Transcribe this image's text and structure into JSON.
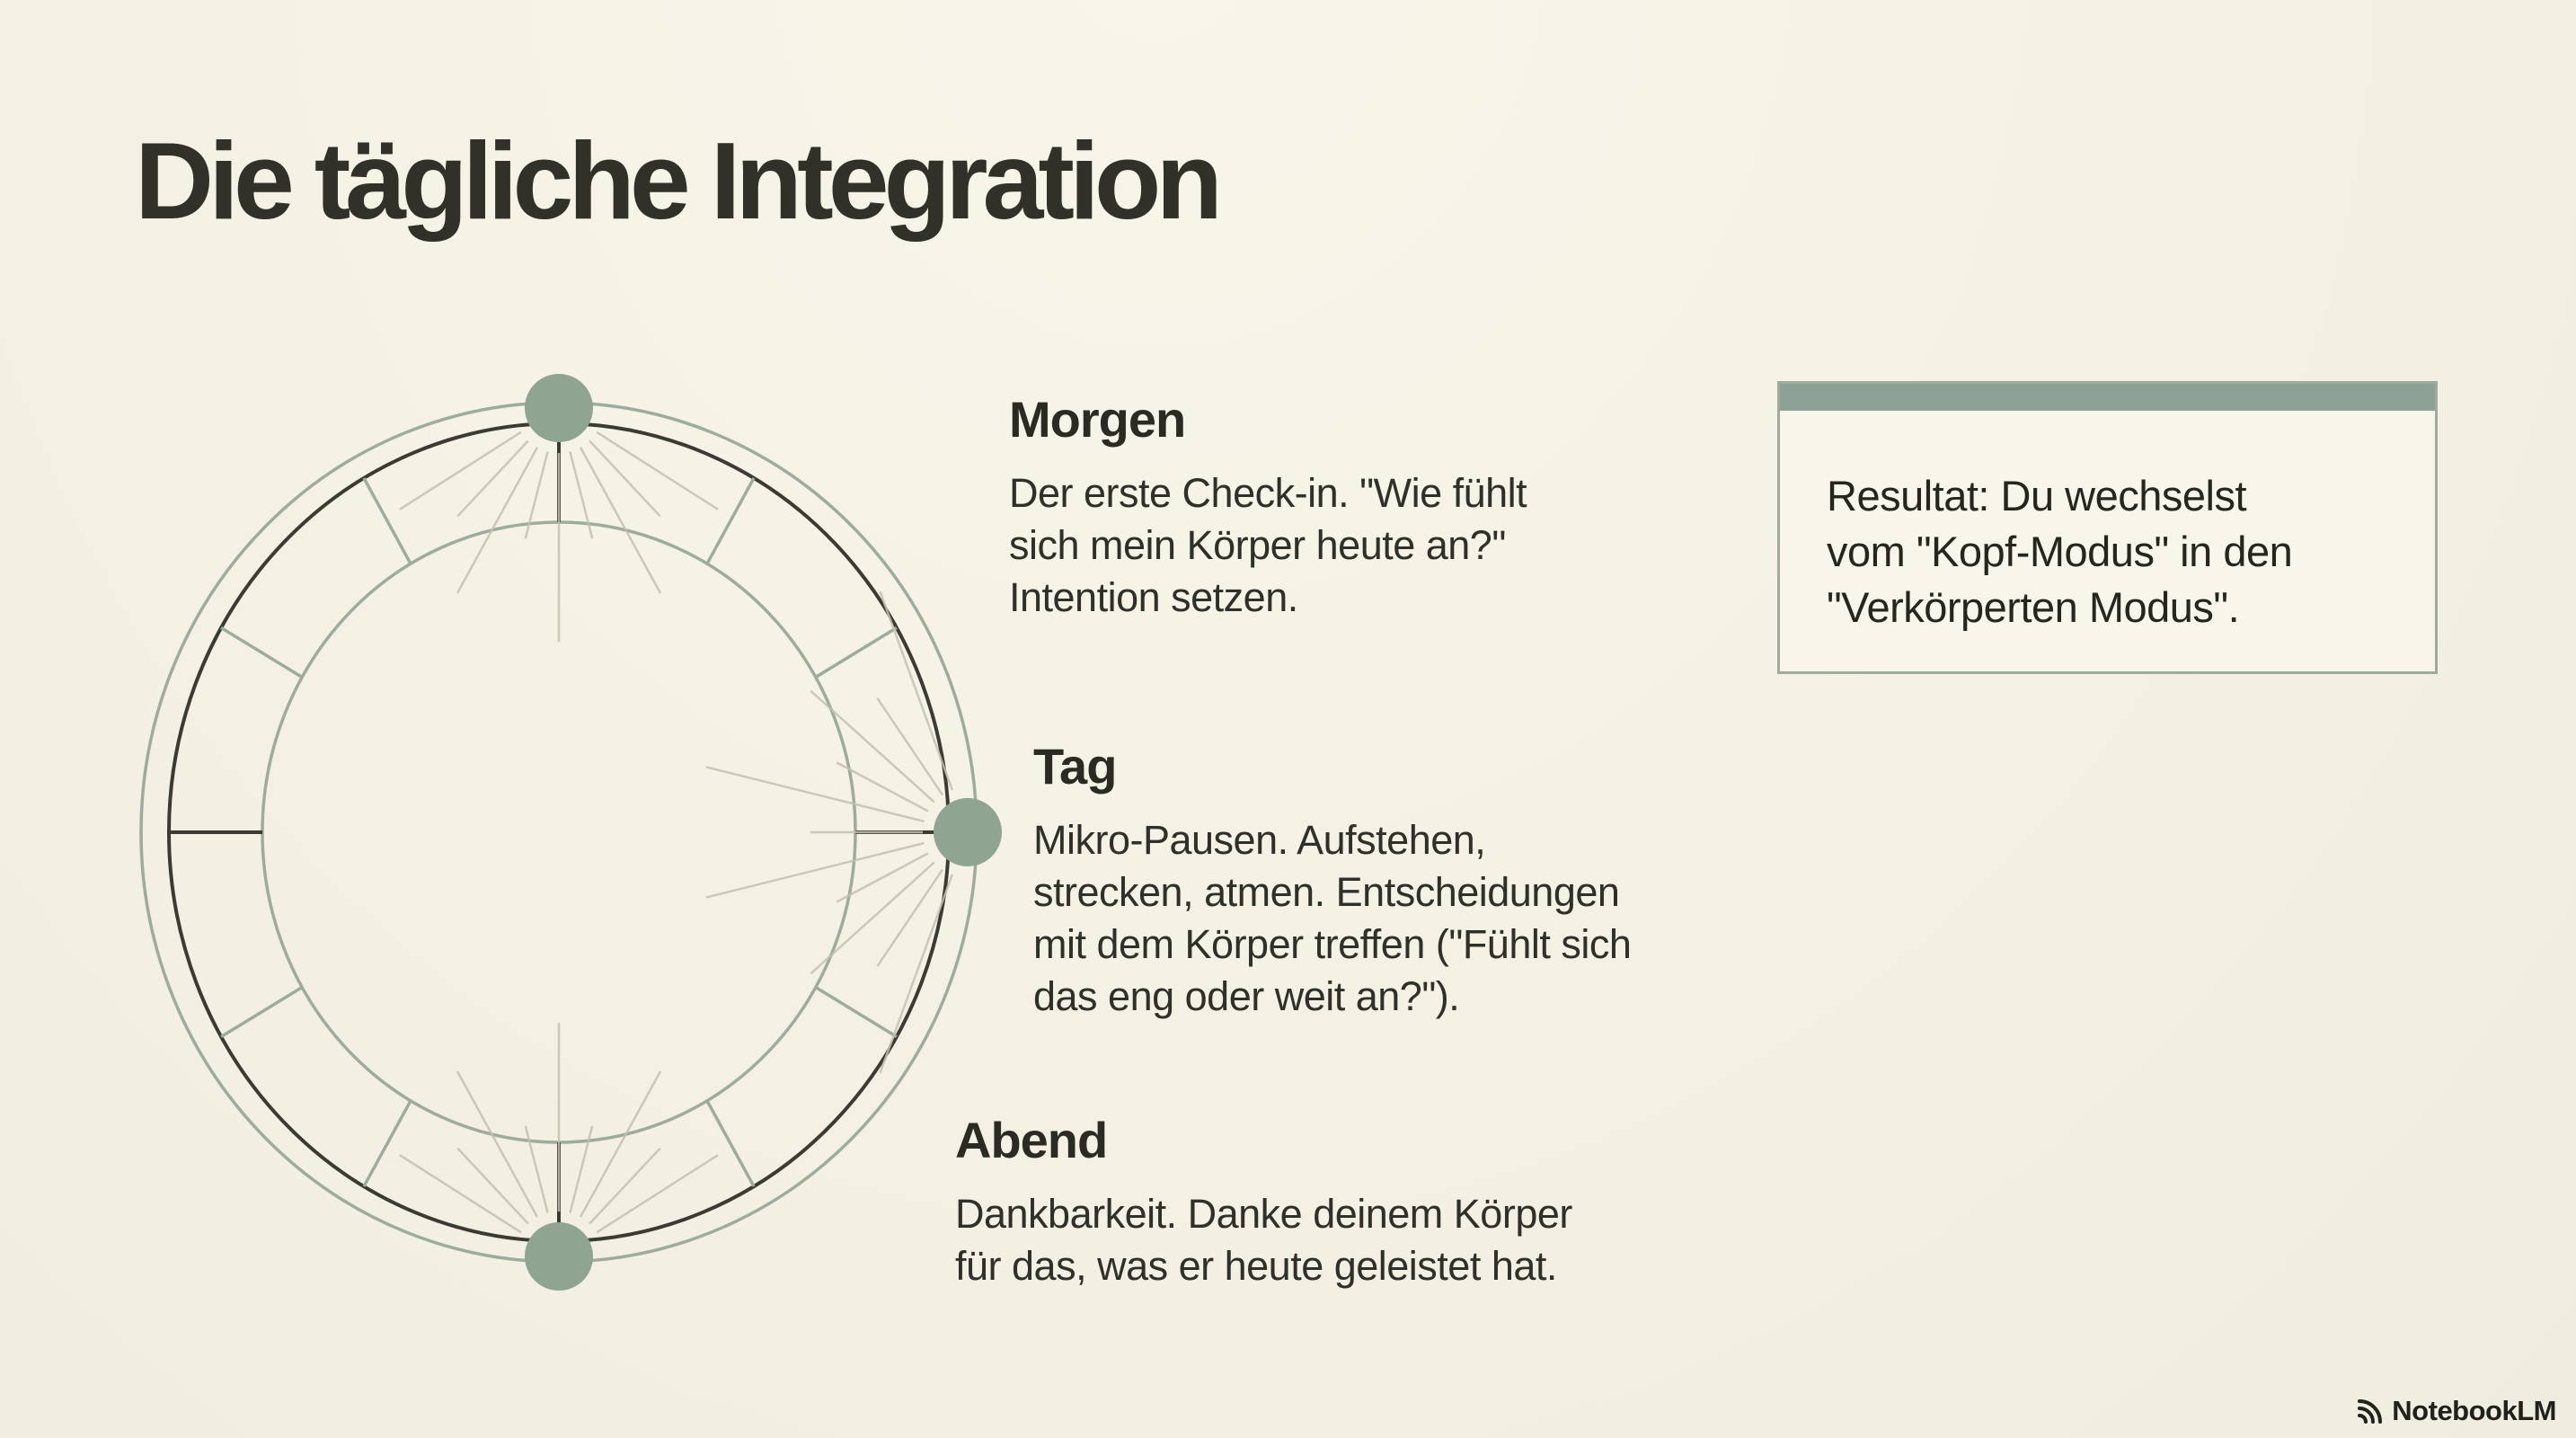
{
  "page": {
    "title": "Die tägliche Integration",
    "background_color": "#f4f1e4"
  },
  "diagram": {
    "type": "daily-cycle-clock-ring",
    "segments": 12,
    "colors": {
      "sage_line": "#9dac9c",
      "dark_line": "#3b3b33",
      "dot_fill": "#8fa592",
      "ray_line": "#c4c1ae"
    },
    "phases": [
      {
        "id": "morgen",
        "label": "Morgen",
        "clock_position": "12",
        "description_lines": [
          "Der erste Check-in. \"Wie fühlt",
          "sich mein Körper heute an?\"",
          "Intention setzen."
        ]
      },
      {
        "id": "tag",
        "label": "Tag",
        "clock_position": "3",
        "description_lines": [
          "Mikro-Pausen. Aufstehen,",
          "strecken, atmen. Entscheidungen",
          "mit dem Körper treffen (\"Fühlt sich",
          "das eng oder weit an?\")."
        ]
      },
      {
        "id": "abend",
        "label": "Abend",
        "clock_position": "6",
        "description_lines": [
          "Dankbarkeit. Danke deinem Körper",
          "für das, was er heute geleistet hat."
        ]
      }
    ]
  },
  "result_box": {
    "accent_color": "#8da294",
    "text_lines": [
      "Resultat: Du wechselst",
      "vom \"Kopf-Modus\" in den",
      "\"Verkörperten Modus\"."
    ]
  },
  "footer": {
    "brand": "NotebookLM"
  }
}
